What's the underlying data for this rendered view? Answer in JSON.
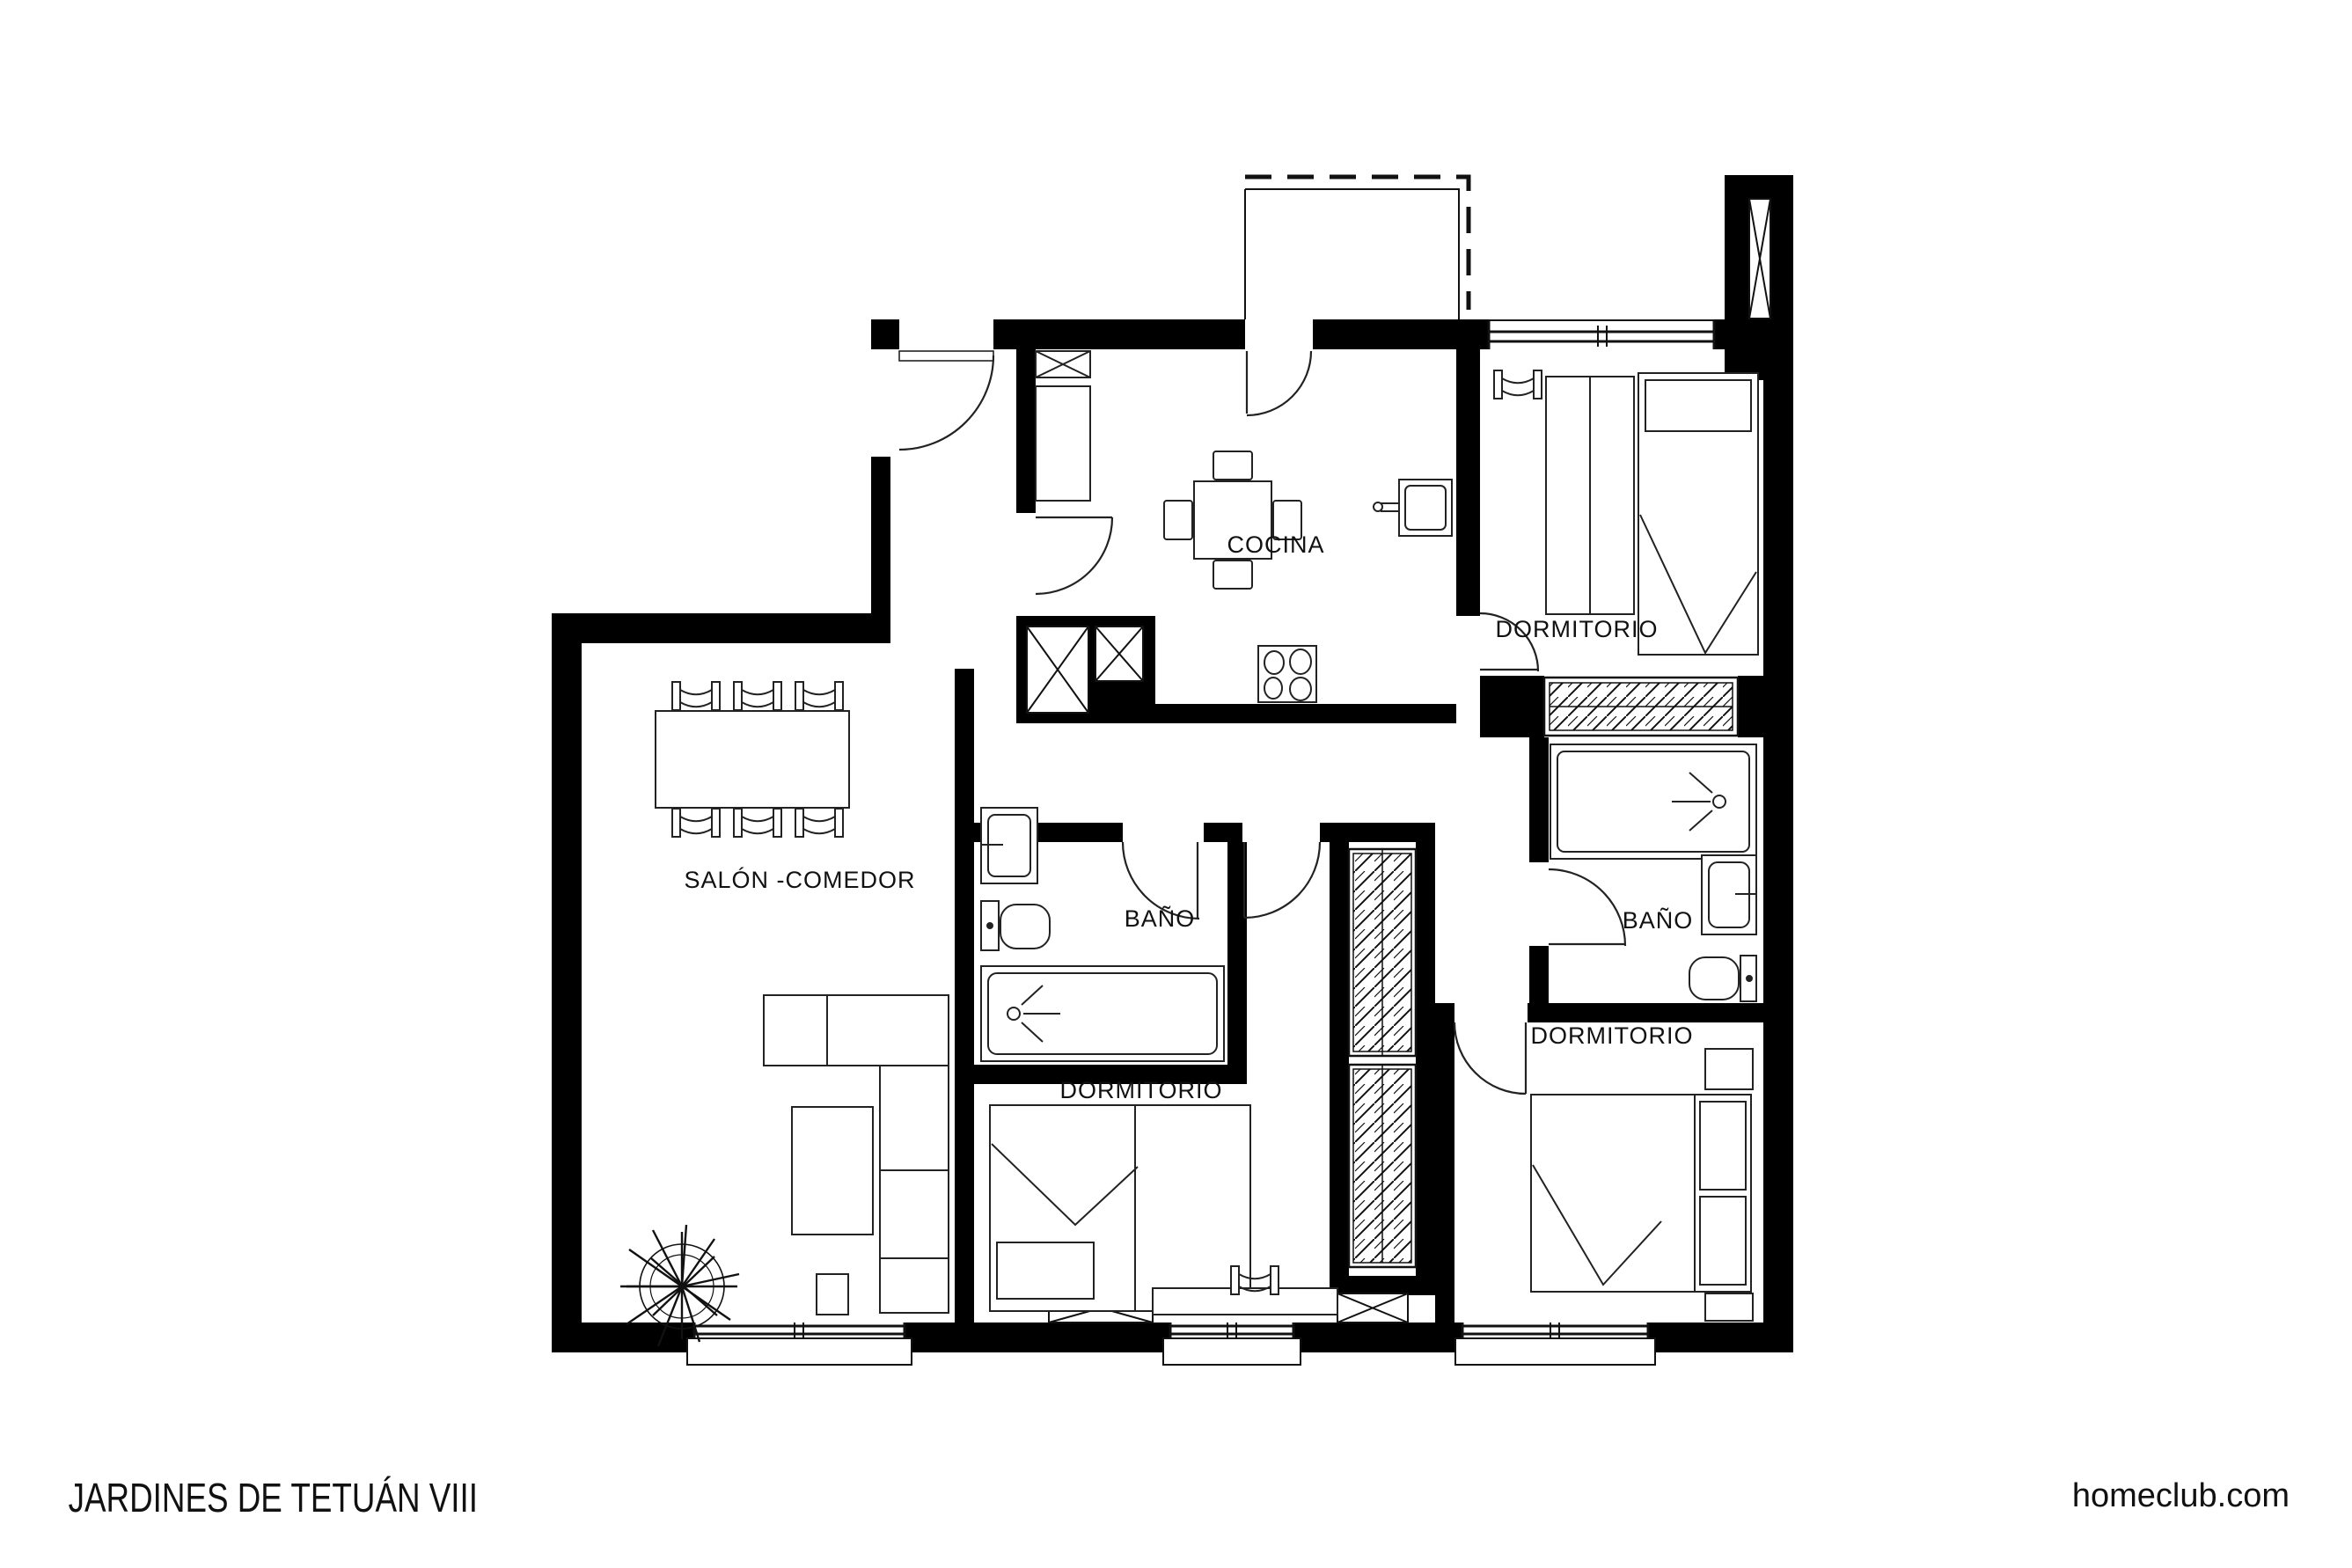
{
  "title": "JARDINES DE TETUÁN VIII",
  "brand": "homeclub.com",
  "rooms": [
    {
      "id": "cocina",
      "label": "COCINA"
    },
    {
      "id": "dormitorio-top",
      "label": "DORMITORIO"
    },
    {
      "id": "salon-comedor",
      "label": "SALÓN -COMEDOR"
    },
    {
      "id": "bano-1",
      "label": "BAÑO"
    },
    {
      "id": "dormitorio-center",
      "label": "DORMITORIO"
    },
    {
      "id": "bano-2",
      "label": "BAÑO"
    },
    {
      "id": "dormitorio-right",
      "label": "DORMITORIO"
    }
  ],
  "colors": {
    "walls": "#000000",
    "background": "#ffffff",
    "line": "#1a1a1a"
  }
}
